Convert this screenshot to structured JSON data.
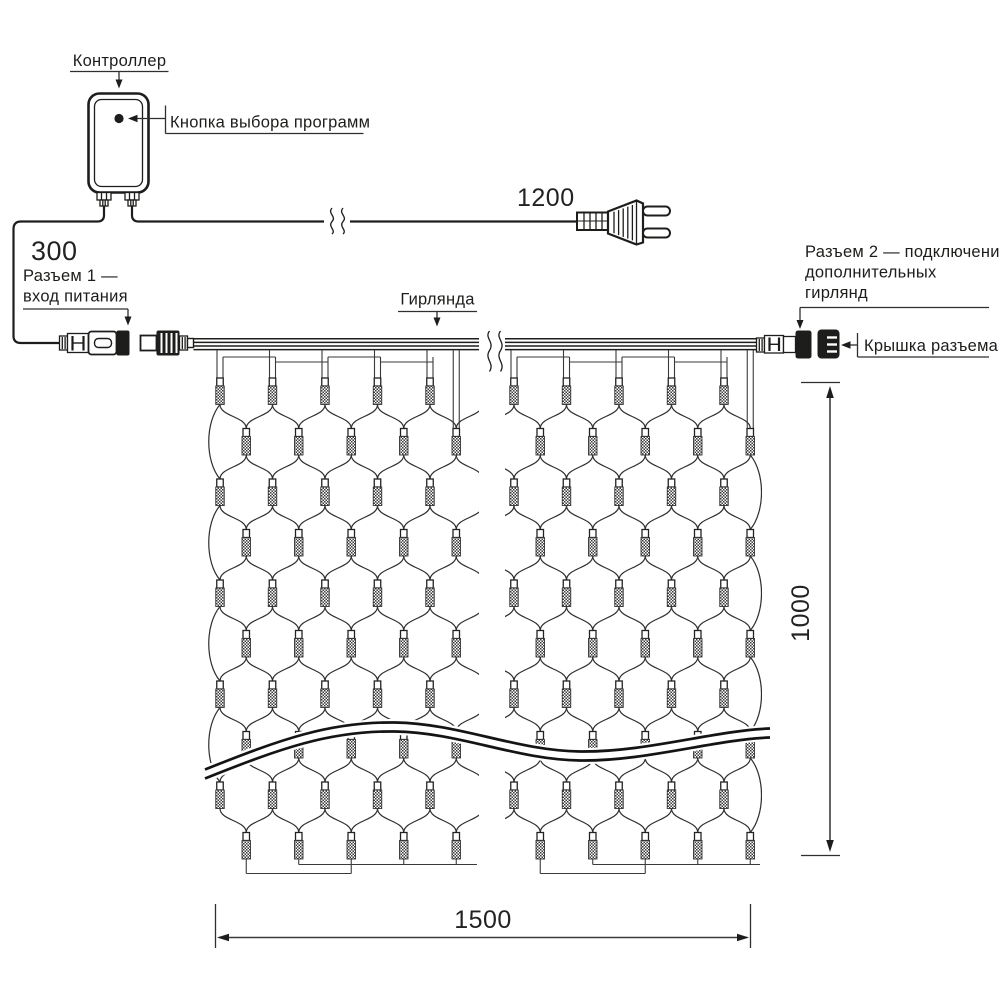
{
  "labels": {
    "controller": "Контроллер",
    "program_button": "Кнопка выбора программ",
    "cord_length": "1200",
    "lead_length": "300",
    "connector1": [
      "Разъем 1 —",
      "вход питания"
    ],
    "garland": "Гирлянда",
    "connector2": [
      "Разъем 2 — подключение",
      "дополнительных",
      "гирлянд"
    ],
    "connector_cap": "Крышка разъема",
    "net_height": "1000",
    "net_width": "1500"
  },
  "colors": {
    "ink": "#1d1d1b",
    "mesh": "#2e2e2e",
    "background": "#ffffff"
  },
  "net": {
    "rows": 10,
    "columns_per_half": 5,
    "row_top_y": 378,
    "row_spacing": 50.5,
    "col_spacing": 52.5,
    "half_offset": 26.25,
    "halves": [
      {
        "odd_start_x": 220,
        "clip": [
          198,
          479
        ]
      },
      {
        "odd_start_x": 514,
        "clip": [
          505,
          762
        ]
      }
    ]
  }
}
